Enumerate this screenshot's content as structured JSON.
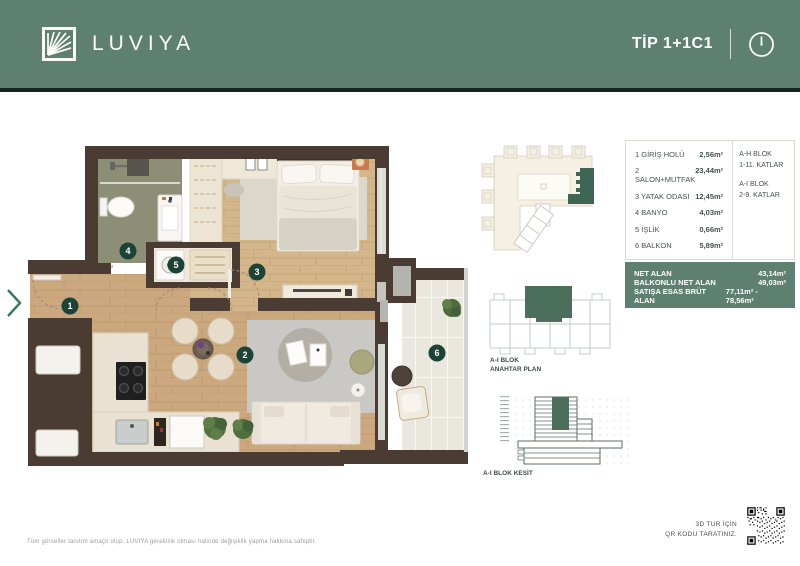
{
  "header": {
    "brand": "LUVIYA",
    "type_label": "TİP 1+1C1"
  },
  "unit_table": {
    "rooms": [
      {
        "label": "1 GİRİŞ HOLÜ",
        "area": "2,56m²"
      },
      {
        "label": "2 SALON+MUTFAK",
        "area": "23,44m²"
      },
      {
        "label": "3 YATAK ODASI",
        "area": "12,45m²"
      },
      {
        "label": "4 BANYO",
        "area": "4,03m²"
      },
      {
        "label": "5 İŞLİK",
        "area": "0,66m²"
      },
      {
        "label": "6 BALKON",
        "area": "5,89m²"
      }
    ],
    "blocks": [
      {
        "name": "A-H BLOK",
        "floors": "1-11. KATLAR"
      },
      {
        "name": "A-I BLOK",
        "floors": "2-9. KATLAR"
      }
    ],
    "summary": [
      {
        "label": "NET ALAN",
        "value": "43,14m²"
      },
      {
        "label": "BALKONLU NET ALAN",
        "value": "49,03m²"
      },
      {
        "label": "SATIŞA ESAS BRÜT ALAN",
        "value": "77,11m² - 78,56m²"
      }
    ]
  },
  "key_plan": {
    "block": "A-I BLOK",
    "label": "ANAHTAR PLAN"
  },
  "section": {
    "label": "A-I BLOK KESİT"
  },
  "plan": {
    "badges": [
      "1",
      "2",
      "3",
      "4",
      "5",
      "6"
    ]
  },
  "footer": {
    "disclaimer": "Tüm görseller tanıtım amaçlı olup, LUVIYA gereklilik olması halinde değişiklik yapma hakkına sahiptir.",
    "qr_line1": "3D TUR İÇİN",
    "qr_line2": "QR KODU TARATINIZ."
  },
  "colors": {
    "header_bg": "#5D8071",
    "header_underline": "#16241D",
    "panel_green": "#5D8071",
    "badge_green": "#1B4336",
    "wall_brown": "#4A3B33",
    "chevron_green": "#37795D"
  }
}
